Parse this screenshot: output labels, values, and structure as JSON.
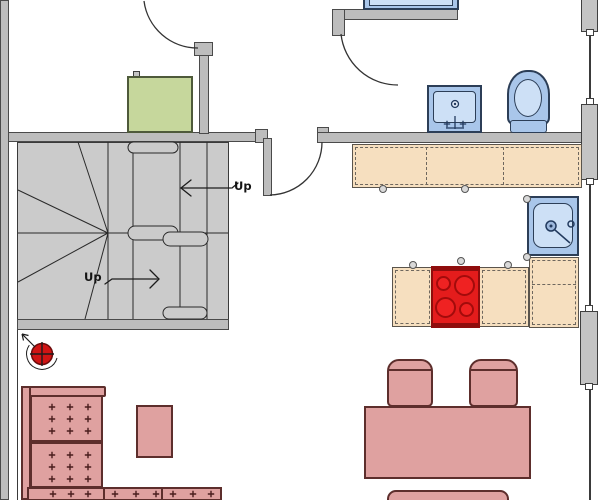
{
  "title": "apartment-floor-plan",
  "labels": {
    "up_upper": "Up",
    "up_lower": "Up"
  },
  "colors": {
    "wall": "#bdbdbd",
    "stair": "#cbcbcb",
    "line": "#2a2a2a",
    "counter": "#f6dfbf",
    "cooktop": "#e41c1c",
    "cooktop-edge": "#8f0d0d",
    "fixture": "#a9c6ea",
    "fixture-inner": "#cde0f6",
    "furniture": "#dfa1a0",
    "furniture-edge": "#5d2e2c",
    "cabinet-green": "#c6d79c",
    "alarm-red": "#d01414"
  },
  "elements": {
    "stair": {
      "flights": 2,
      "winders": true,
      "labels": [
        "Up",
        "Up"
      ]
    },
    "fixtures": [
      "bathtub",
      "bathroom-sink",
      "toilet",
      "kitchen-sink",
      "cooktop",
      "kitchen-counter",
      "kitchen-island"
    ],
    "furniture": [
      "sectional-sofa",
      "side-table",
      "dining-table",
      "dining-chair",
      "dining-chair",
      "bench",
      "green-cabinet"
    ],
    "openings": [
      "door-top-left",
      "door-hall",
      "door-bathroom",
      "window",
      "window",
      "window"
    ],
    "annotations": [
      "ceiling-fixture-symbol"
    ]
  }
}
